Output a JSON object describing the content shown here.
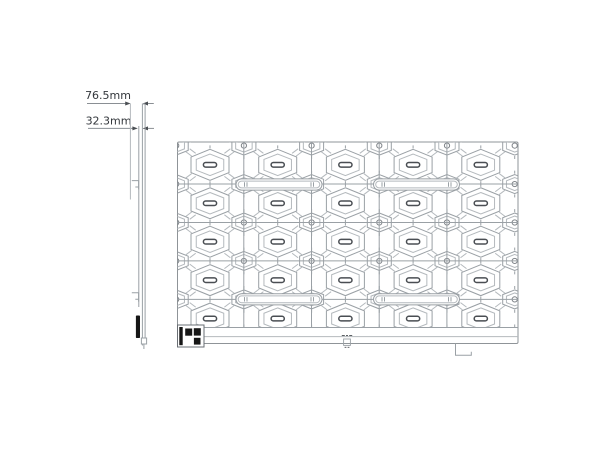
{
  "dimensions": {
    "total_depth": {
      "label": "76.5mm"
    },
    "mount_depth": {
      "label": "32.3mm"
    }
  },
  "colors": {
    "background": "#ffffff",
    "panel_border": "#8f9498",
    "line": "#9aa0a5",
    "line_light": "#b4b9bd",
    "seam": "#9aa0a5",
    "dim_line": "#8a8f94",
    "dark_accent": "#4a4e53",
    "text": "#33373c",
    "black_fill": "#161616"
  }
}
